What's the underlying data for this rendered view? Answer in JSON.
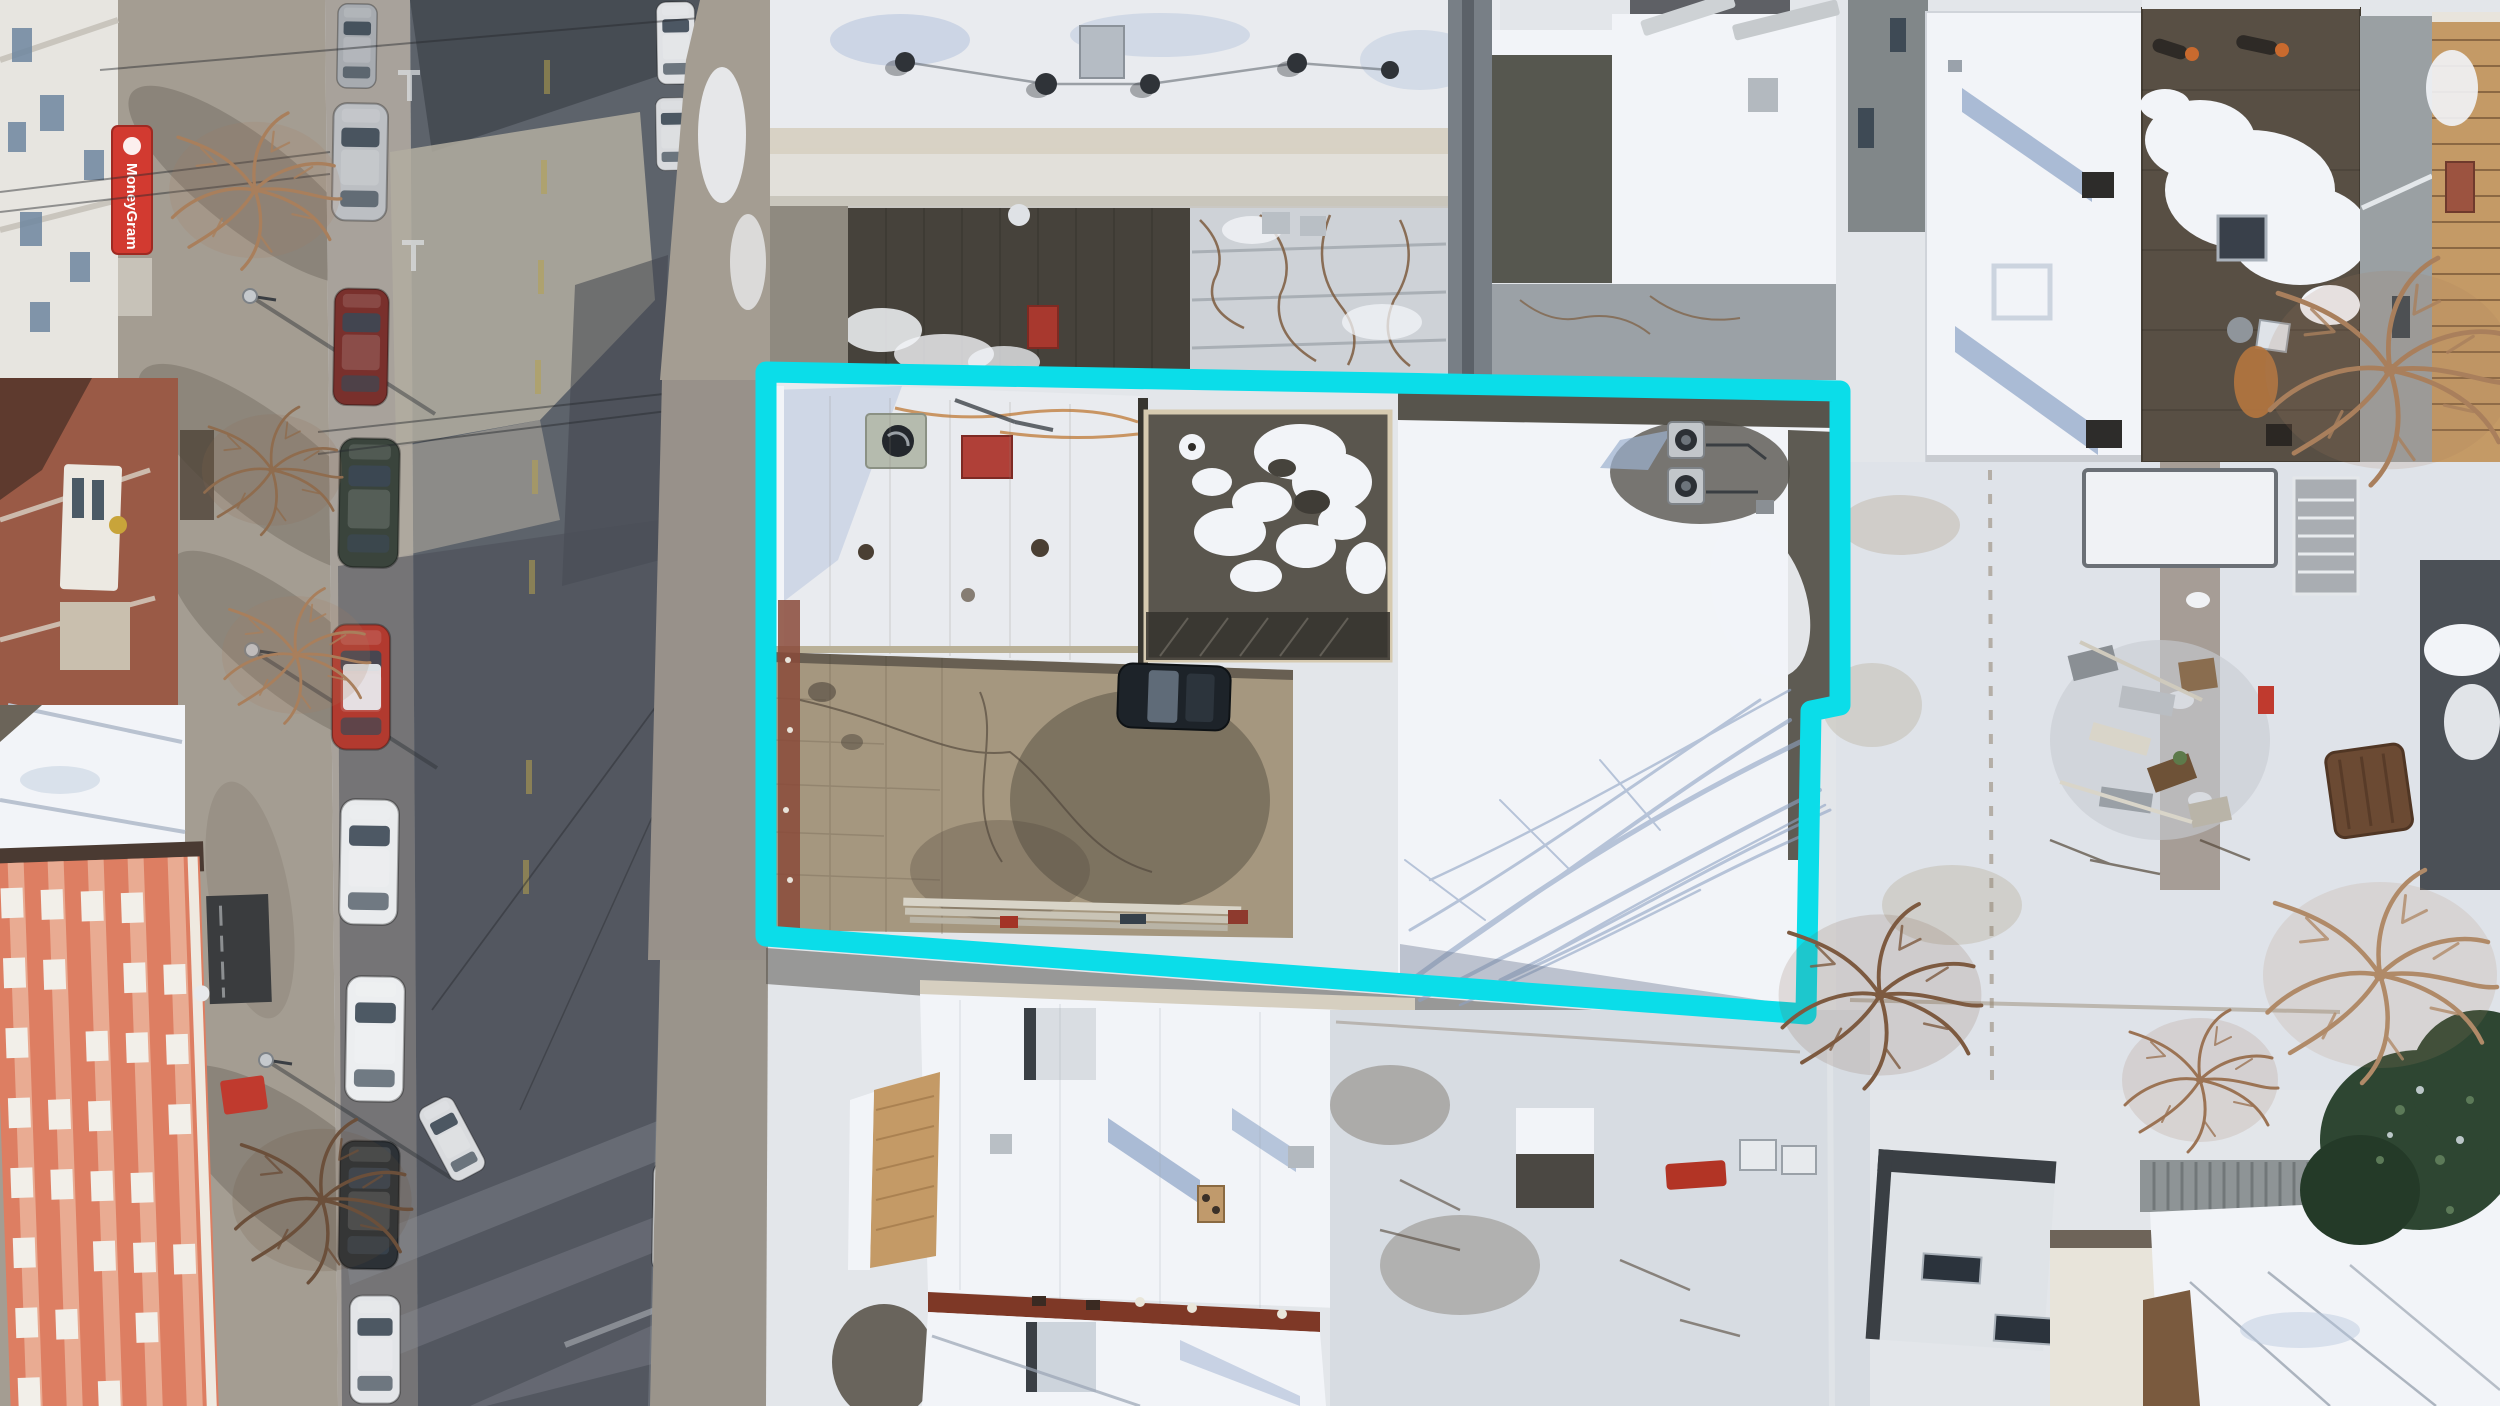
{
  "scene": {
    "description": "Winter aerial drone photo of an urban block: diagonal street with parked cars on the left, snow-covered rowhouse roofs, backyards with bare trees, and a cyan property-boundary outline around a central lot",
    "season": "winter"
  },
  "annotation": {
    "type": "property-boundary",
    "color": "#0bdde9",
    "stroke_width": 21
  },
  "road_markings": {
    "driveway_text_line1": "DRIVE",
    "driveway_text_line2": "WAY",
    "text_color": "#d9d4c4"
  },
  "signs": {
    "storefront_awning": "MoneyGram",
    "awning_color": "#d23a30",
    "awning_text_color": "#ffffff"
  },
  "palette": {
    "asphalt": "#5d636b",
    "asphalt_dark": "#41464e",
    "asphalt_light": "#8d939b",
    "concrete": "#a8a29b",
    "sidewalk": "#a49d92",
    "sidewalk_light": "#c2bbae",
    "snow": "#f2f4f8",
    "snow_shadow": "#b9c7de",
    "snow_blue": "#9db0cf",
    "white_roof": "#e9ebef",
    "dark_roof": "#46423b",
    "brown_roof": "#584f44",
    "tan": "#d6cfc0",
    "tan_shingle": "#c49a66",
    "orange_building": "#dd7e62",
    "brick": "#9a5a46",
    "red_strip": "#7e3826",
    "red": "#c03a2e",
    "rust": "#c08040",
    "yard": "#a5977f",
    "evergreen": "#2e4632",
    "wire": "#26292d"
  }
}
